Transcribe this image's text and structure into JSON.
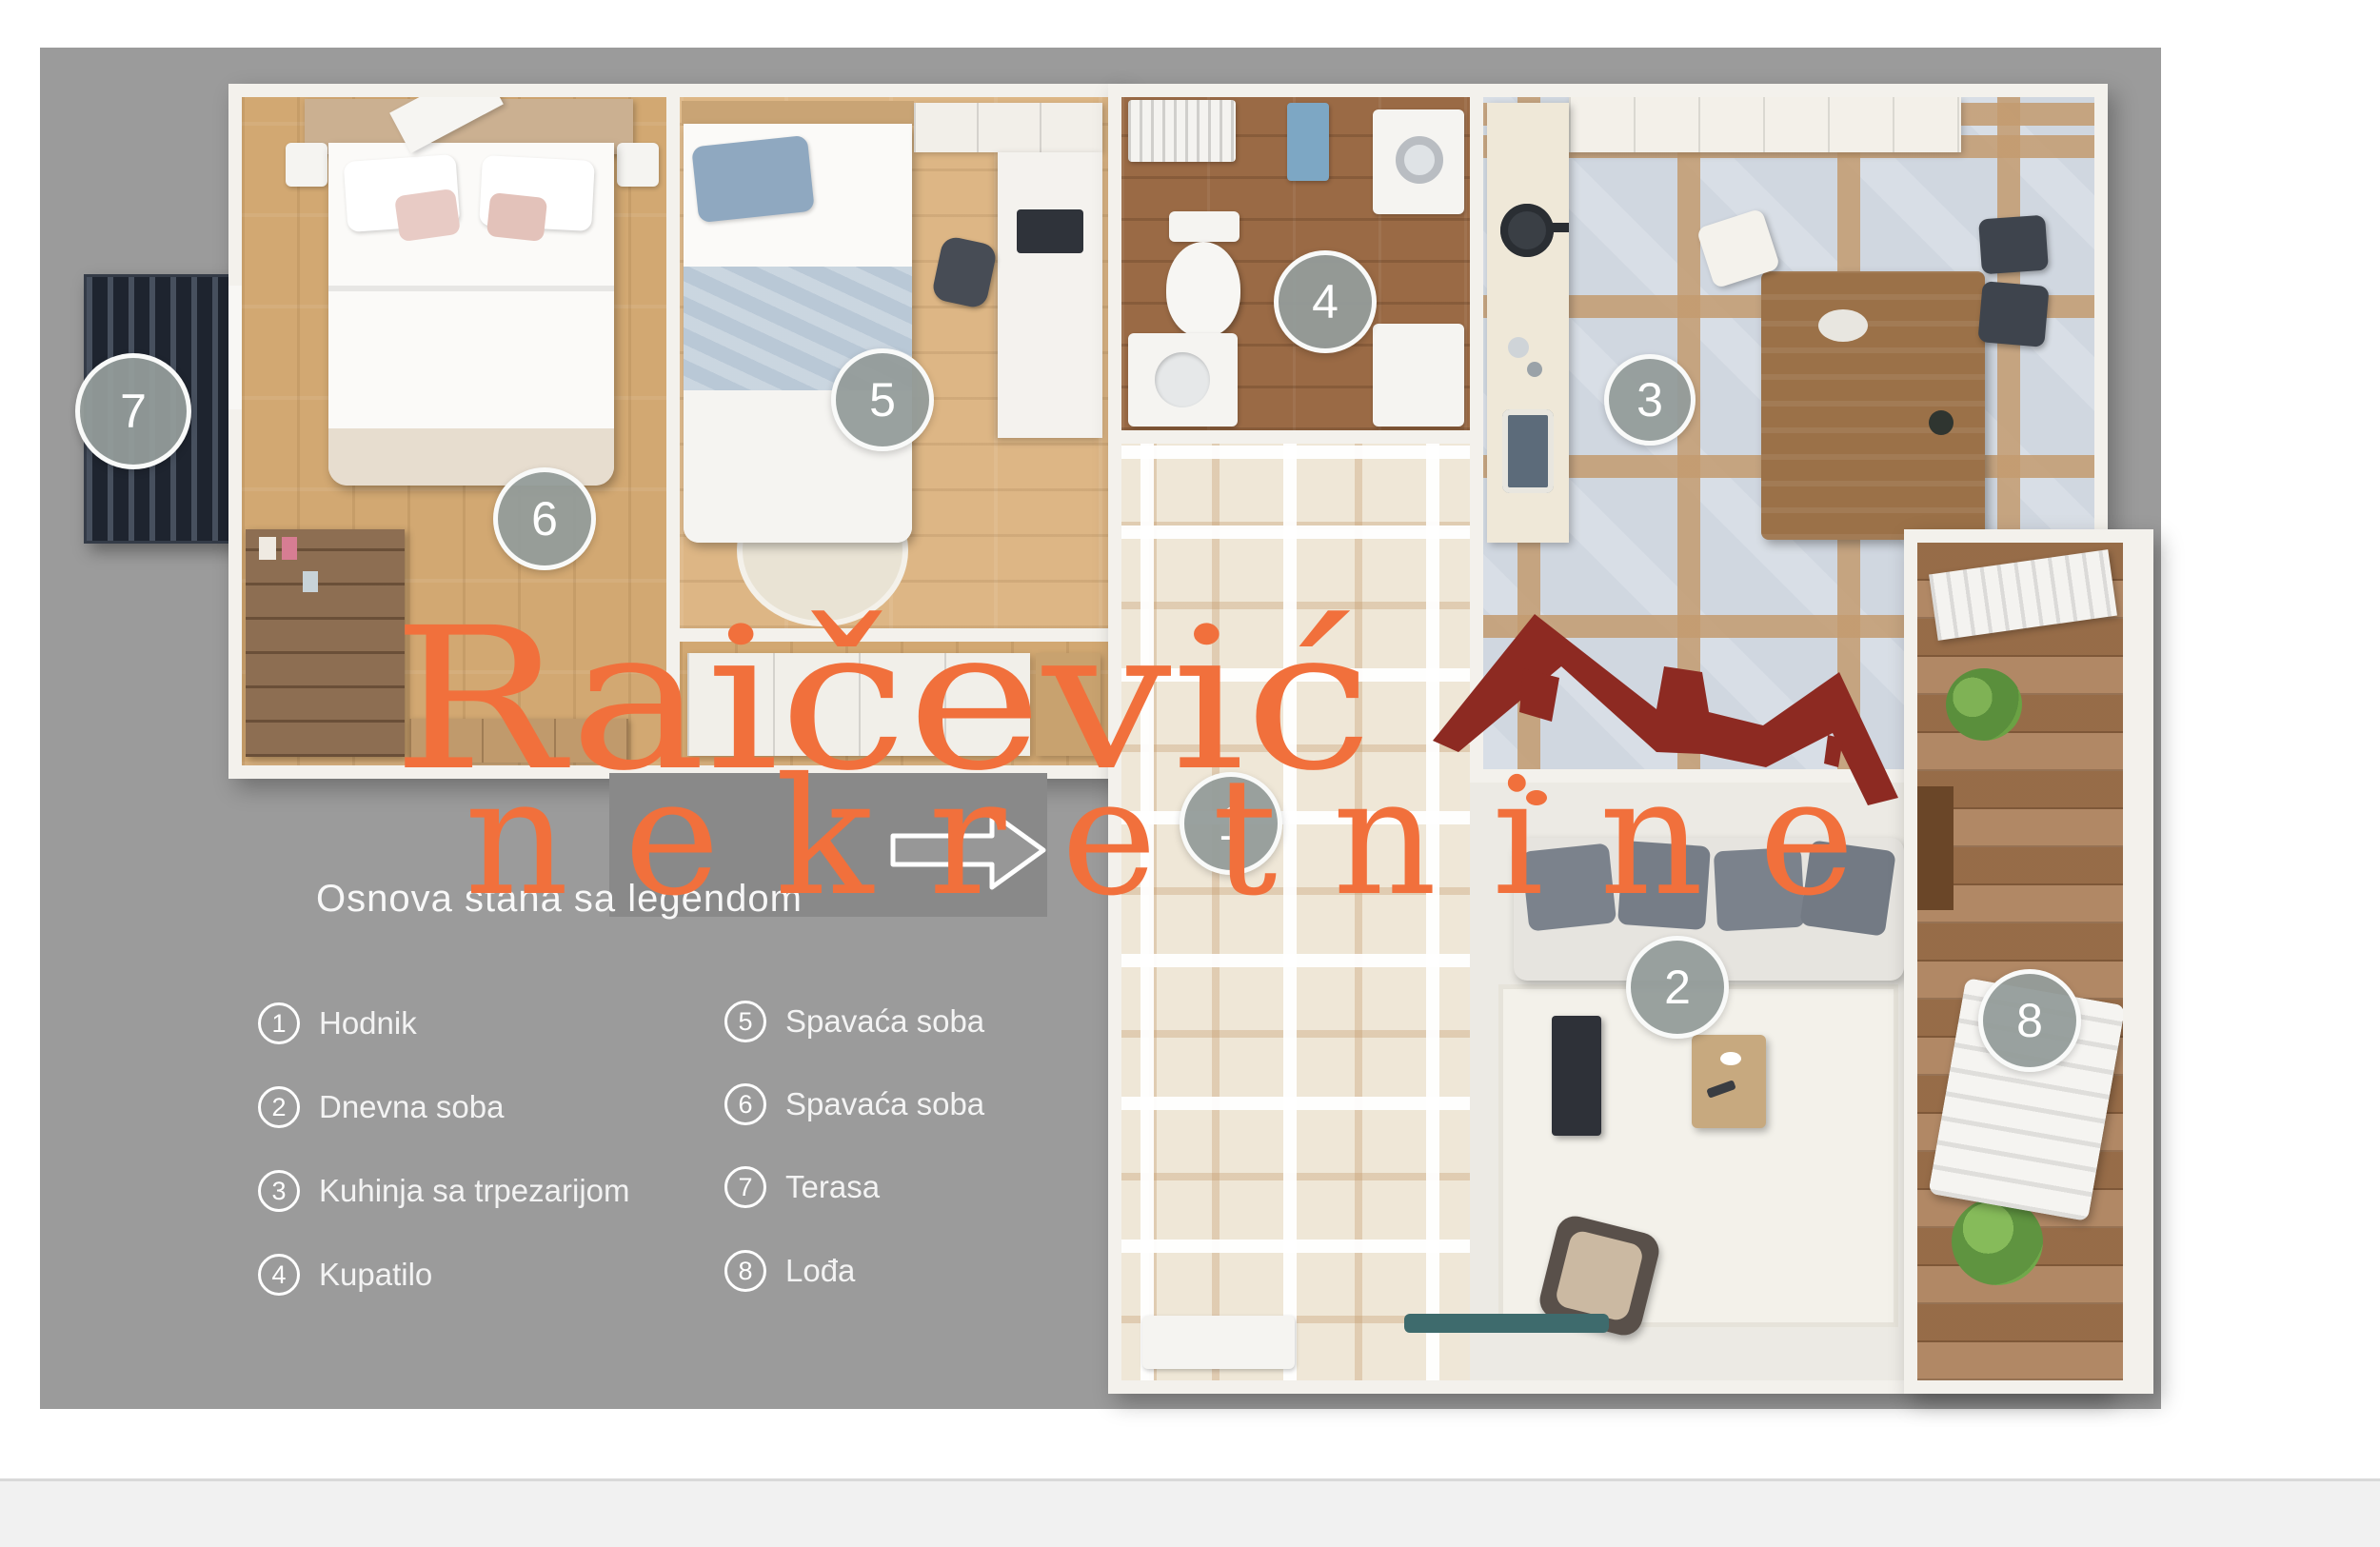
{
  "title": "Osnova stana sa legendom",
  "watermark": {
    "brand": "Raičević",
    "brand_sub": "nekretnine",
    "accent_color": "#f1703c",
    "roof_color": "#8d2a22"
  },
  "colors": {
    "canvas_background": "#9b9b9b",
    "overlay_box": "#898989",
    "badge_fill": "#949c9a",
    "footer_strip": "#f1f1f1"
  },
  "plan": {
    "badges": [
      {
        "num": "1"
      },
      {
        "num": "2"
      },
      {
        "num": "3"
      },
      {
        "num": "4"
      },
      {
        "num": "5"
      },
      {
        "num": "6"
      },
      {
        "num": "7"
      },
      {
        "num": "8"
      }
    ]
  },
  "legend": {
    "items": [
      {
        "num": "1",
        "label": "Hodnik"
      },
      {
        "num": "2",
        "label": "Dnevna soba"
      },
      {
        "num": "3",
        "label": "Kuhinja sa trpezarijom"
      },
      {
        "num": "4",
        "label": "Kupatilo"
      },
      {
        "num": "5",
        "label": "Spavaća soba"
      },
      {
        "num": "6",
        "label": "Spavaća soba"
      },
      {
        "num": "7",
        "label": "Terasa"
      },
      {
        "num": "8",
        "label": "Lođa"
      }
    ]
  }
}
